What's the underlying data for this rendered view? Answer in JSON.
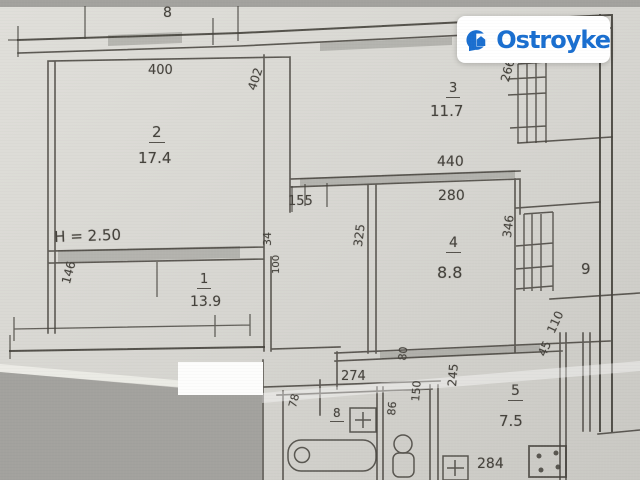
{
  "brand": {
    "name": "Ostroyke"
  },
  "colors": {
    "logo_blue": "#1a6fd0",
    "paper": "#d8d7d2",
    "background": "#a7a6a2",
    "ink": "#45423c"
  },
  "plan": {
    "note_height": "H = 2.50",
    "rooms": [
      {
        "number": "2",
        "area": "17.4"
      },
      {
        "number": "1",
        "area": "13.9"
      },
      {
        "number": "3",
        "area": "11.7"
      },
      {
        "number": "4",
        "area": "8.8"
      },
      {
        "number": "5",
        "area": "7.5"
      }
    ],
    "dims": {
      "top": "8",
      "room2_w": "400",
      "room2_h": "402",
      "room1_side": "146",
      "d34": "34",
      "d100": "100",
      "room3_h": "266",
      "d440": "440",
      "d280": "280",
      "d155": "155",
      "d325": "325",
      "d346": "346",
      "d9": "9",
      "d110": "110",
      "d45": "45",
      "d274": "274",
      "d80": "80",
      "d78": "78",
      "bath_num": "8",
      "d86": "86",
      "d150": "150",
      "d245": "245",
      "d284": "284"
    }
  }
}
